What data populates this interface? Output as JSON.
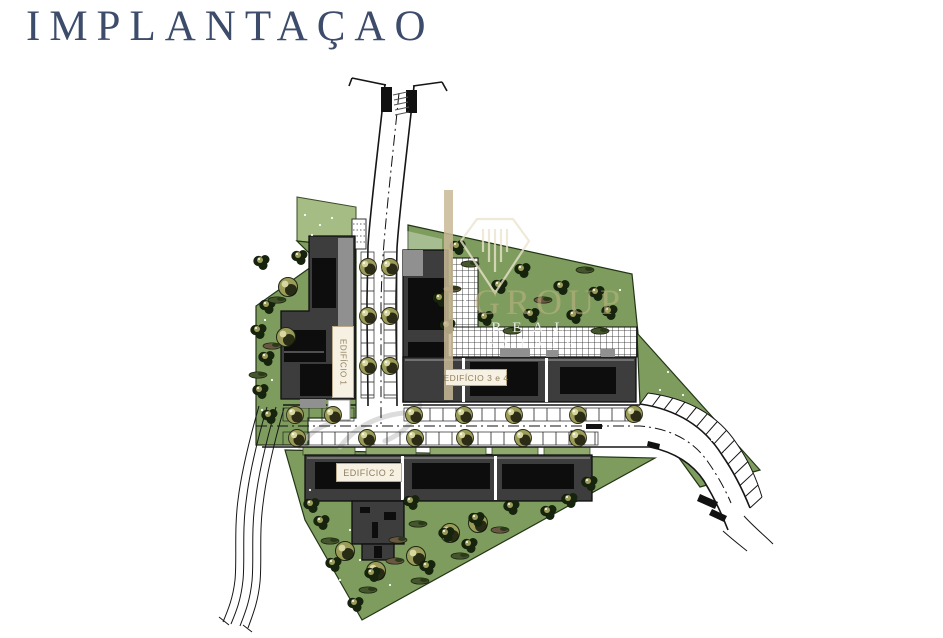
{
  "page": {
    "title": "IMPLANTAÇAO"
  },
  "plan": {
    "labels": {
      "building1": "EDIFÍCIO 1",
      "building2": "EDIFÍCIO 2",
      "building34": "EDIFÍCIO 3 e 4"
    },
    "watermark": {
      "word1": "GROUP",
      "word2": "REAL",
      "word3": "ESTATE"
    },
    "colors": {
      "title_text": "#3d4c6b",
      "green": "#7d9c5d",
      "green_light": "#a6bc85",
      "green_strip": "#8fa86c",
      "building": "#3d3d3d",
      "building_dark": "#0d0d0d",
      "building_light": "#909090",
      "tree_olive": "#9b9c59",
      "tree_olive_highlight": "#d6d6a0",
      "tree_dark": "#16230d",
      "shrub_green": "#45562d",
      "shrub_brown": "#6a5741",
      "label_text": "#8f7f5c",
      "label_bg": "#f7f1e4",
      "watermark_tan": "#c9ba96",
      "road_line": "#161616"
    }
  }
}
